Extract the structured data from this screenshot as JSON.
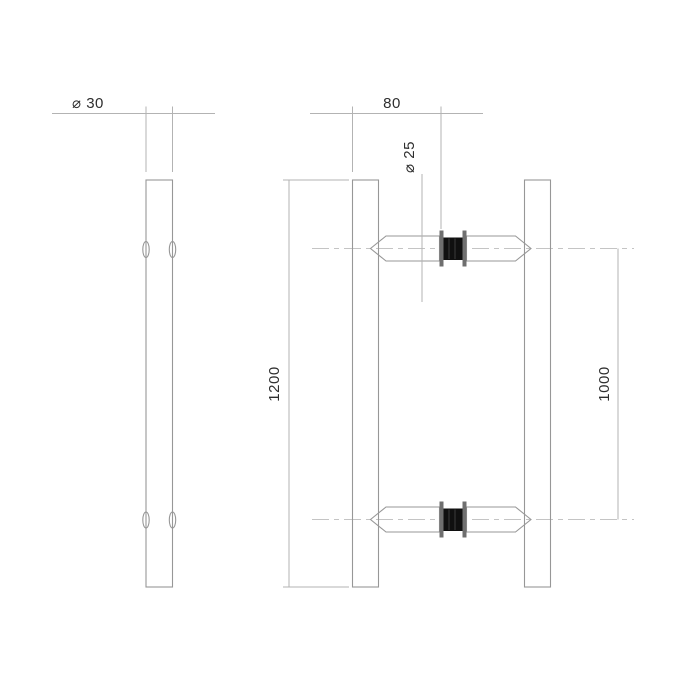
{
  "drawing": {
    "type": "technical-dimension-drawing",
    "subject": "pair of tubular door pull handles, side view and front view",
    "labels": {
      "side_diameter": "⌀ 30",
      "spacing": "80",
      "tube_diameter": "⌀ 25",
      "total_length": "1200",
      "hole_distance": "1000"
    },
    "colors": {
      "background": "#ffffff",
      "object_line": "#979797",
      "dimension_line": "#b3b3b3",
      "center_line": "#c4c4c4",
      "label_text": "#2e2e2e",
      "flange": "#6f6f6f",
      "spacer": "#101010"
    }
  }
}
